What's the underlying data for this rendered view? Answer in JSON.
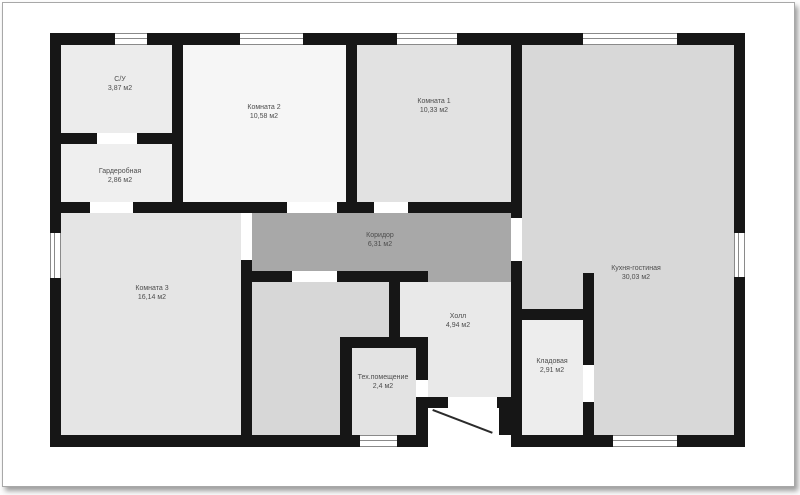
{
  "plan": {
    "wall_color": "#161616",
    "door_gap_color": "#ffffff",
    "frame": {
      "border_color": "#a8a8a8",
      "background": "#ffffff"
    },
    "rooms": {
      "su": {
        "label": "С/У",
        "area": "3,87 м2",
        "color": "#ececec"
      },
      "garderobnaya": {
        "label": "Гардеробная",
        "area": "2,86 м2",
        "color": "#efefef"
      },
      "komnata2": {
        "label": "Комната 2",
        "area": "10,58 м2",
        "color": "#f6f6f6"
      },
      "komnata1": {
        "label": "Комната 1",
        "area": "10,33 м2",
        "color": "#e2e2e2"
      },
      "koridor": {
        "label": "Коридор",
        "area": "6,31 м2",
        "color": "#a8a8a8"
      },
      "komnata3": {
        "label": "Комната 3",
        "area": "16,14 м2",
        "color": "#e5e5e5"
      },
      "backroom": {
        "color": "#d7d7d7"
      },
      "holl": {
        "label": "Холл",
        "area": "4,94 м2",
        "color": "#e9e9e9"
      },
      "tehpom": {
        "label": "Тех.помещение",
        "area": "2,4 м2",
        "color": "#e3e3e3"
      },
      "kladovaya": {
        "label": "Кладовая",
        "area": "2,91 м2",
        "color": "#ededed"
      },
      "kuhnya": {
        "label": "Кухня-гостиная",
        "area": "30,03 м2",
        "color": "#d8d8d8"
      }
    }
  }
}
